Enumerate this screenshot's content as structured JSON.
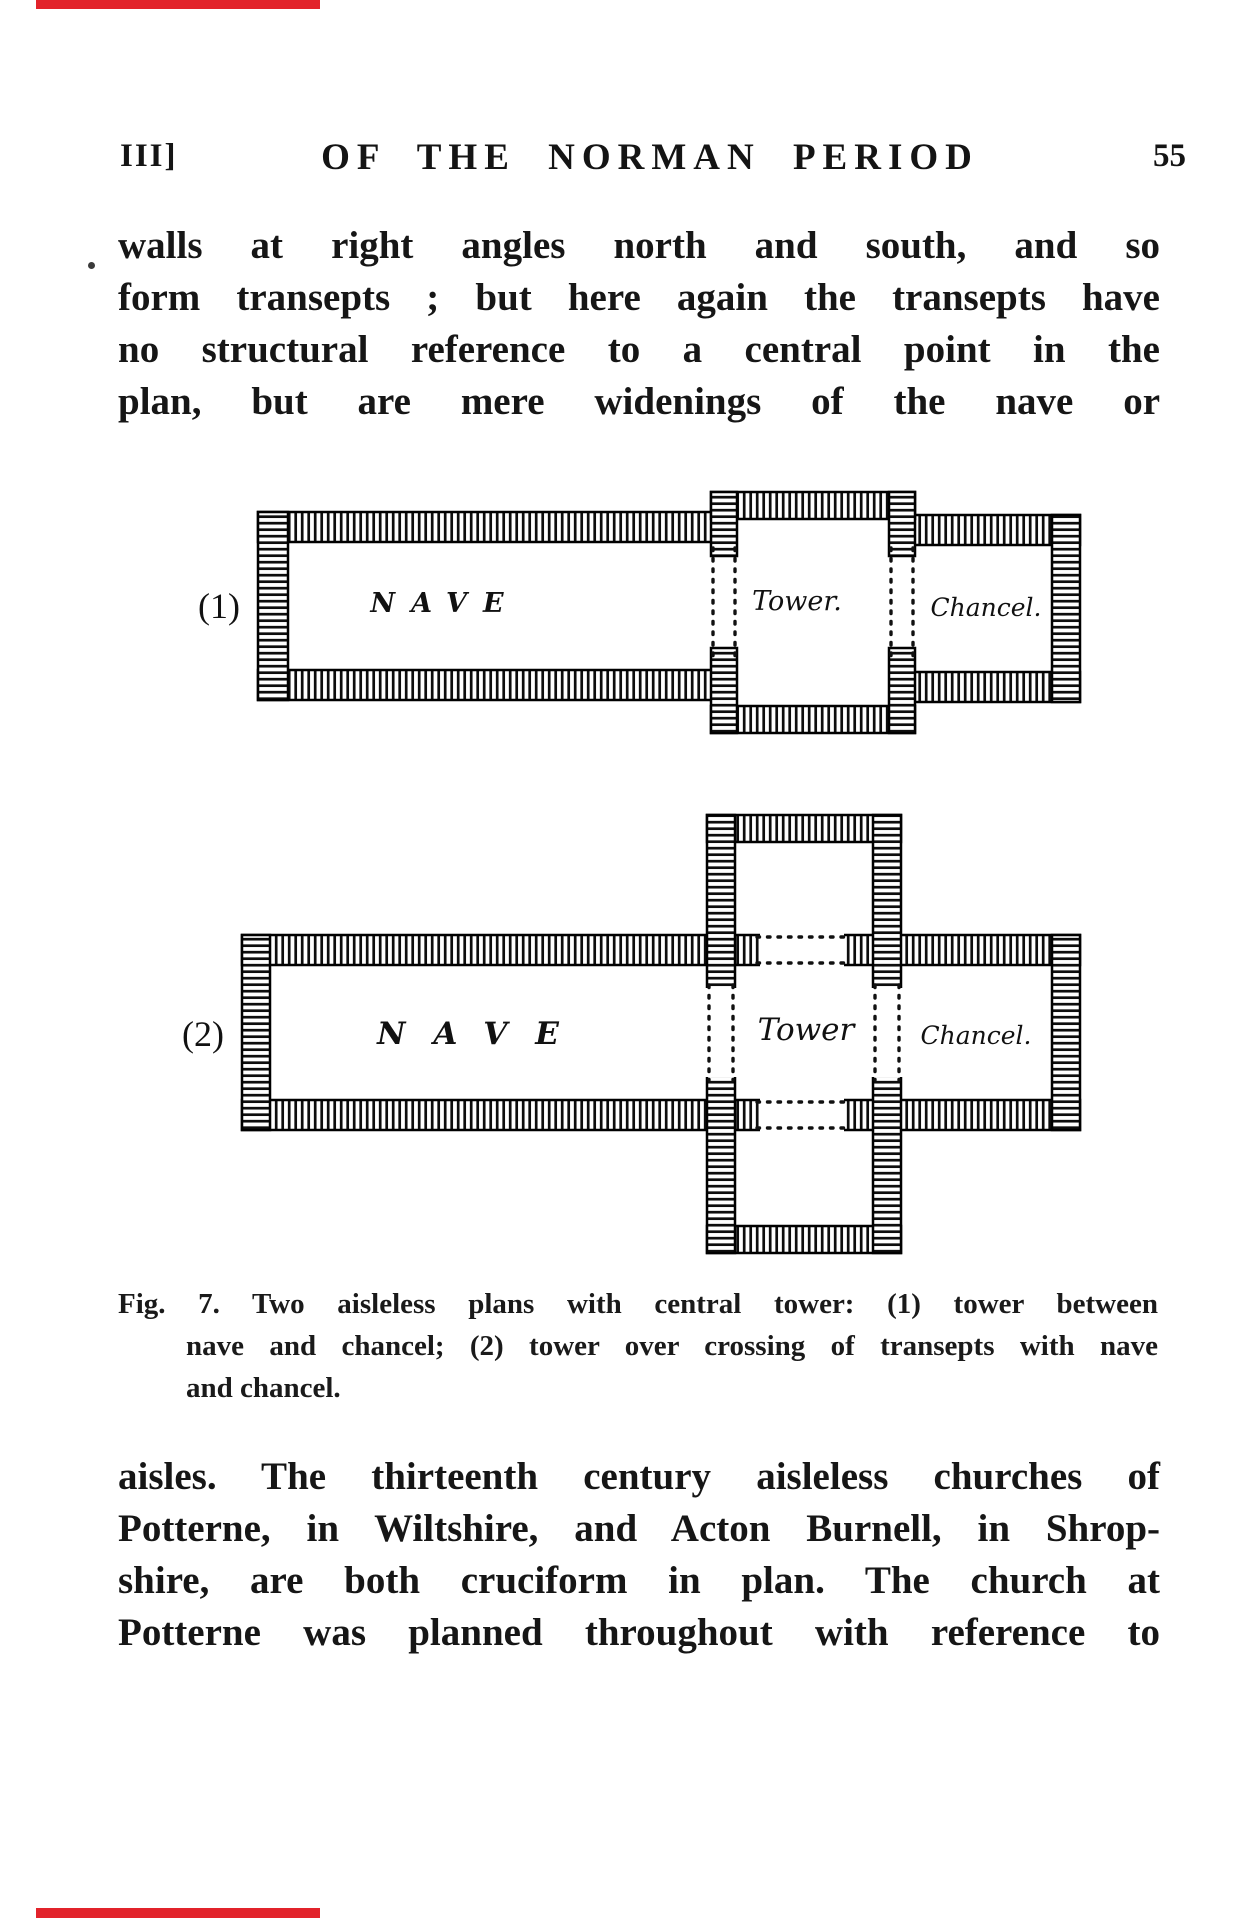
{
  "header": {
    "left": "III]",
    "center": "OF THE NORMAN PERIOD",
    "right": "55"
  },
  "paragraph1": {
    "lines": [
      "walls at right angles north and south, and so",
      "form transepts ; but here again the transepts have",
      "no structural reference to a central point in the",
      "plan, but are mere widenings of the nave or"
    ]
  },
  "figure": {
    "plan1": {
      "index": "(1)",
      "nave": "NAVE",
      "tower": "Tower.",
      "chancel": "Chancel."
    },
    "plan2": {
      "index": "(2)",
      "nave": "NAVE",
      "tower": "Tower",
      "chancel": "Chancel."
    },
    "caption": {
      "lines": [
        "Fig. 7.  Two aisleless plans with central tower: (1) tower between",
        "nave and chancel; (2) tower over crossing of transepts with nave",
        "and chancel."
      ]
    }
  },
  "paragraph2": {
    "lines": [
      "aisles.  The thirteenth century aisleless churches of",
      "Potterne, in Wiltshire, and Acton Burnell, in Shrop-",
      "shire, are both cruciform in plan.  The church at",
      "Potterne was planned throughout with reference to"
    ]
  },
  "scan": {
    "edge_color": "#e2232b"
  }
}
